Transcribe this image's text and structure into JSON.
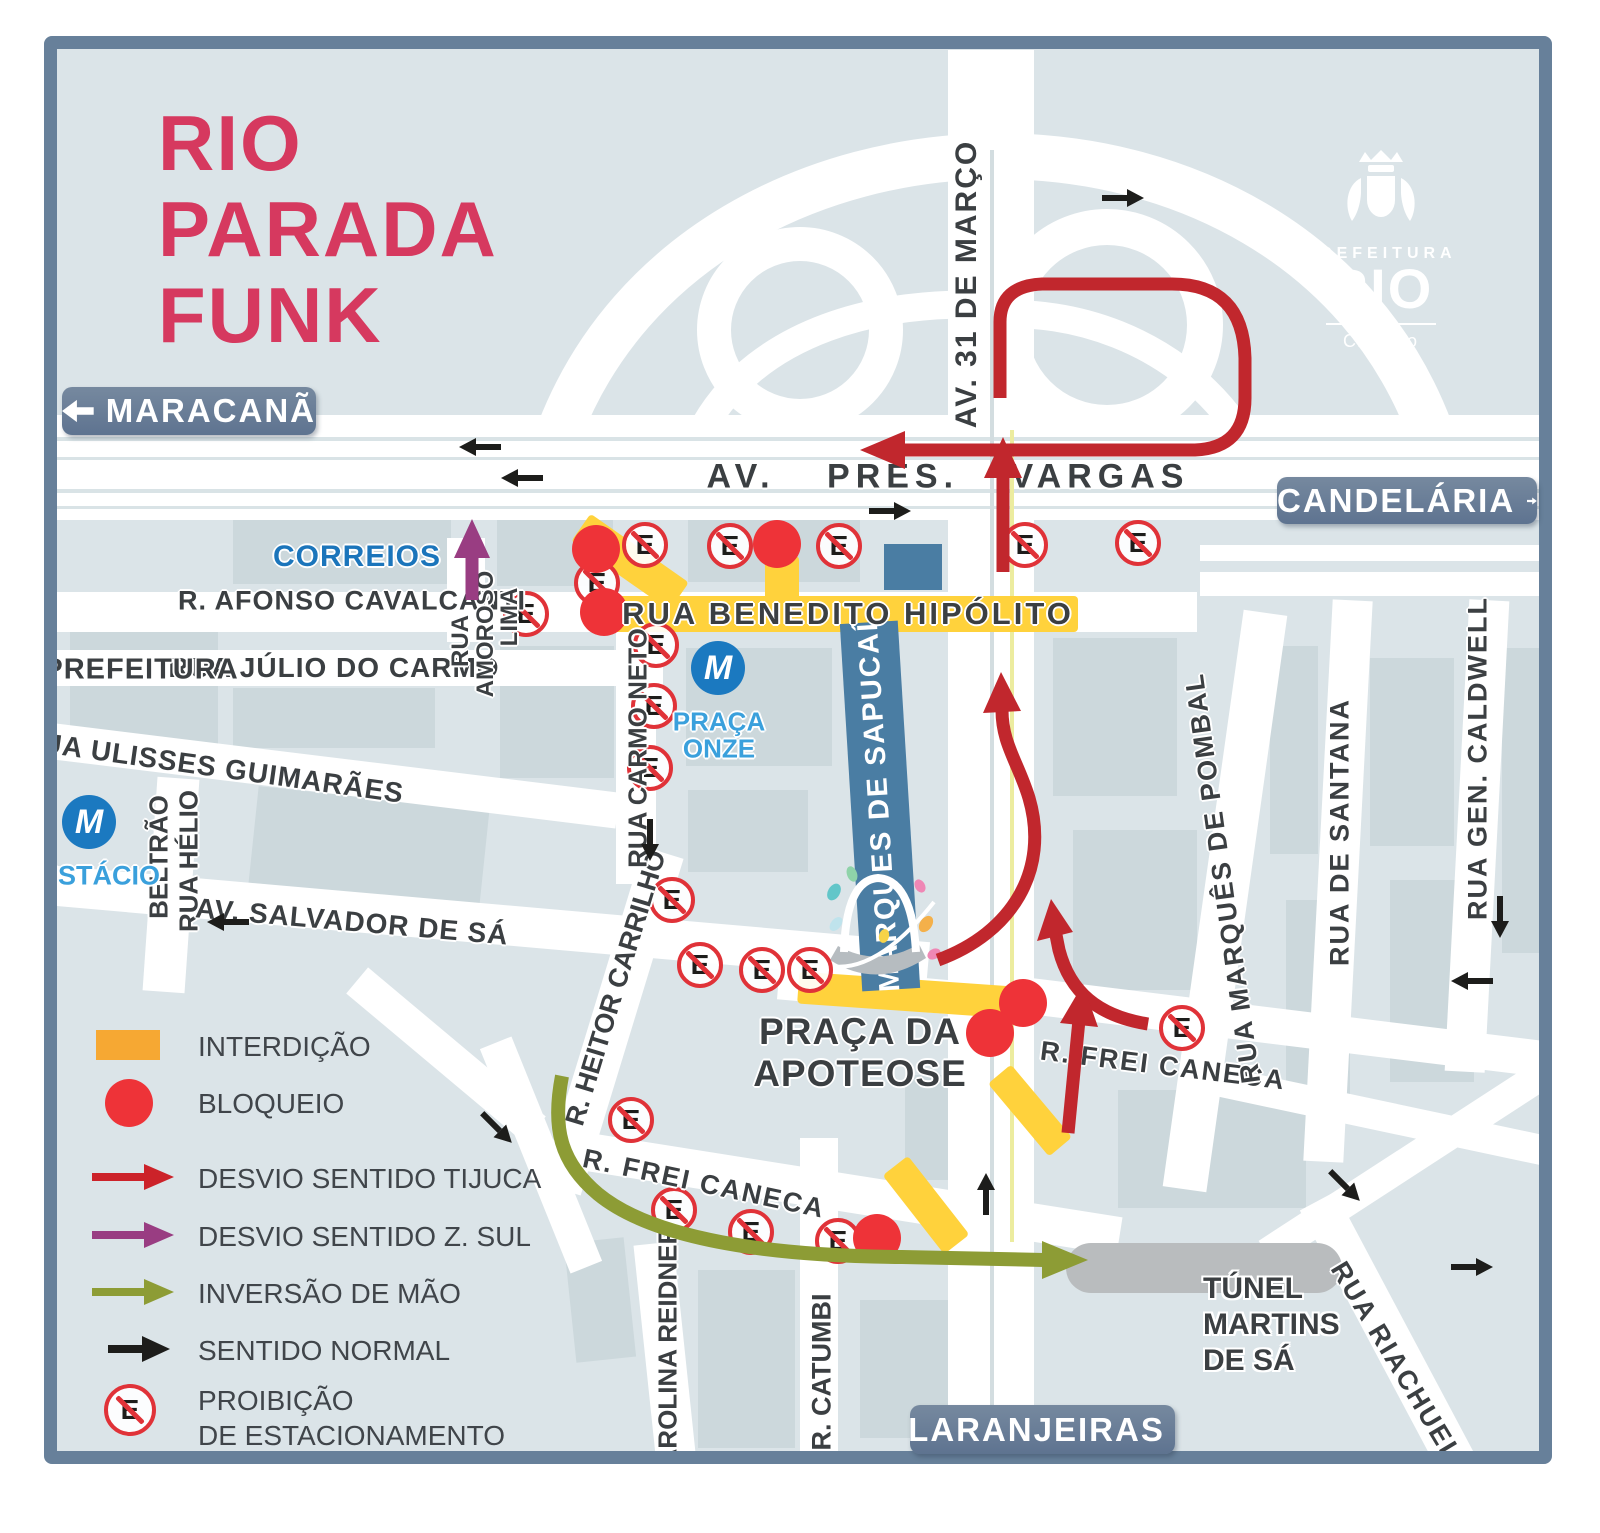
{
  "title": {
    "lines": [
      "RIO",
      "PARADA",
      "FUNK"
    ]
  },
  "logo": {
    "prefeitura": "PREFEITURA",
    "rio": "RIO",
    "org": "CET-Rio"
  },
  "direction_signs": {
    "maracana": "MARACANÃ",
    "candelaria": "CANDELÁRIA",
    "laranjeiras": "LARANJEIRAS"
  },
  "legend": {
    "interdicao": "INTERDIÇÃO",
    "bloqueio": "BLOQUEIO",
    "desvio_tijuca": "DESVIO SENTIDO TIJUCA",
    "desvio_zsul": "DESVIO SENTIDO Z. SUL",
    "inversao": "INVERSÃO DE MÃO",
    "sentido_normal": "SENTIDO NORMAL",
    "proibicao_l1": "PROIBIÇÃO",
    "proibicao_l2": "DE ESTACIONAMENTO"
  },
  "streets": {
    "vargas": "AV. PRES. VARGAS",
    "marco31": "AV. 31 DE MARÇO",
    "benedito": "RUA BENEDITO HIPÓLITO",
    "afonso": "R. AFONSO CAVALCANTI",
    "julio": "RUA JÚLIO DO CARMO",
    "amoroso_l1": "RUA",
    "amoroso_l2": "AMOROSO",
    "amoroso_l3": "LIMA",
    "ulisses": "RUA ULISSES GUIMARÃES",
    "helio_l1": "RUA HÉLIO",
    "helio_l2": "BELTRÃO",
    "salvador": "AV. SALVADOR DE SÁ",
    "heitor": "R. HEITOR CARRILHO",
    "carmo_neto": "RUA CARMO NETO",
    "frei_caneca": "R. FREI CANECA",
    "pombal": "RUA MARQUÊS DE POMBAL",
    "santana": "RUA DE SANTANA",
    "caldwell": "RUA GEN. CALDWELL",
    "riachuelo": "RUA RIACHUELO",
    "catumbi": "R. CATUMBI",
    "carolina": "CAROLINA REIDNER",
    "sapucai": "MARQUES DE SAPUCAÍ"
  },
  "places": {
    "correios": "CORREIOS",
    "prefeitura": "PREFEITURA",
    "estacio": "ESTÁCIO",
    "praca_onze_l1": "PRAÇA",
    "praca_onze_l2": "ONZE",
    "apoteose_l1": "PRAÇA DA",
    "apoteose_l2": "APOTEOSE",
    "tunel_l1": "TÚNEL",
    "tunel_l2": "MARTINS",
    "tunel_l3": "DE SÁ",
    "metro_letter": "M"
  },
  "noparking_letter": "E",
  "markers": {
    "no_parking": [
      [
        526,
        614
      ],
      [
        597,
        583
      ],
      [
        645,
        545
      ],
      [
        730,
        546
      ],
      [
        839,
        546
      ],
      [
        1025,
        545
      ],
      [
        1138,
        543
      ],
      [
        656,
        645
      ],
      [
        654,
        706
      ],
      [
        650,
        768
      ],
      [
        672,
        900
      ],
      [
        631,
        1120
      ],
      [
        700,
        965
      ],
      [
        762,
        970
      ],
      [
        810,
        970
      ],
      [
        674,
        1210
      ],
      [
        751,
        1232
      ],
      [
        838,
        1241
      ],
      [
        1182,
        1028
      ]
    ],
    "blockade": [
      [
        596,
        549
      ],
      [
        604,
        612
      ],
      [
        777,
        544
      ],
      [
        1023,
        1003
      ],
      [
        990,
        1033
      ],
      [
        877,
        1238
      ]
    ],
    "normal_arrows": [
      [
        480,
        447,
        180
      ],
      [
        522,
        478,
        180
      ],
      [
        890,
        511,
        0
      ],
      [
        1123,
        198,
        0
      ],
      [
        228,
        922,
        180
      ],
      [
        650,
        840,
        90
      ],
      [
        497,
        1128,
        45
      ],
      [
        986,
        1194,
        -90
      ],
      [
        1500,
        917,
        90
      ],
      [
        1472,
        981,
        180
      ],
      [
        1345,
        1186,
        45
      ],
      [
        1472,
        1267,
        0
      ]
    ]
  },
  "colors": {
    "title_pink": "#d6395f",
    "desvio_red": "#c1272d",
    "blockade_red": "#ee3338",
    "interdiction_yellow": "#ffd23c",
    "legend_orange": "#f6a833",
    "desvio_purple": "#993d82",
    "inversao_olive": "#8d9c35",
    "normal_black": "#1d1d1b",
    "map_bg": "#dbe4e8",
    "block_gray": "#ccd8dc",
    "road_white": "#ffffff",
    "frame_blue": "#67809a",
    "sambadrome_blue": "#4a7da3",
    "metro_blue": "#1b79c0",
    "tunnel_gray": "#b9bcbe",
    "label_dark": "#3b3f42"
  }
}
